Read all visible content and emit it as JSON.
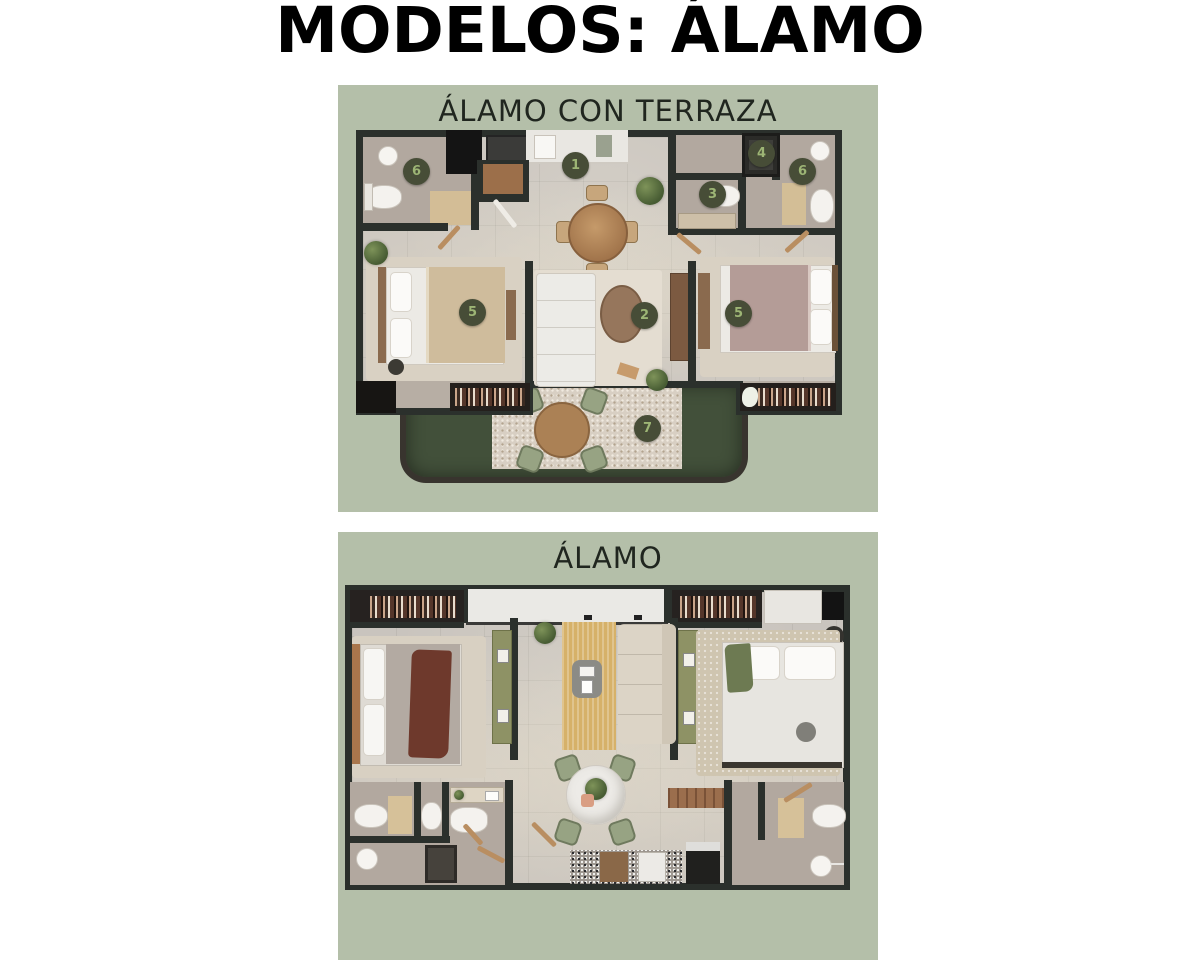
{
  "page": {
    "title": "MODELOS: ÁLAMO"
  },
  "plan1": {
    "title": "ÁLAMO CON TERRAZA",
    "markers": [
      {
        "label": "1"
      },
      {
        "label": "2"
      },
      {
        "label": "3"
      },
      {
        "label": "4"
      },
      {
        "label": "5"
      },
      {
        "label": "5"
      },
      {
        "label": "6"
      },
      {
        "label": "6"
      },
      {
        "label": "7"
      }
    ]
  },
  "plan2": {
    "title": "ÁLAMO"
  },
  "colors": {
    "panel_background": "#b4bfa9",
    "wall": "#2b302c",
    "floor": "#cac5bf",
    "bath_floor": "#b3a99f",
    "grass": "#42503a",
    "patio": "#d8cfc3",
    "marker_background": "#474d37",
    "marker_text": "#9db575",
    "wood": "#a97c52",
    "title_text": "#000000",
    "panel_title_text": "#20261f"
  }
}
